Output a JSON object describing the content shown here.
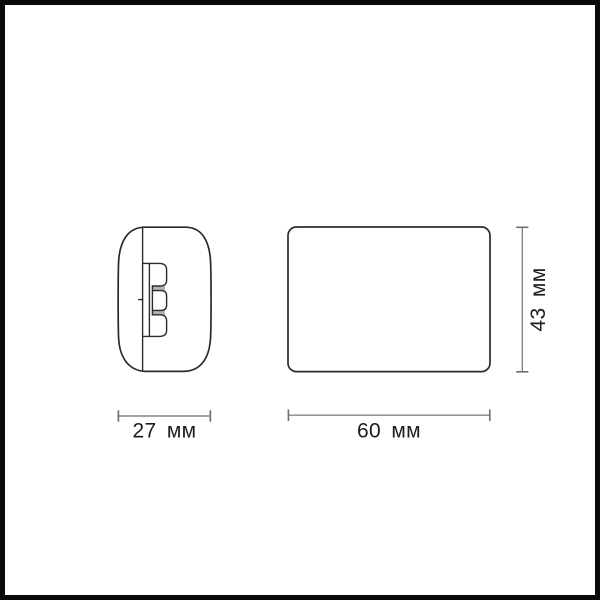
{
  "colors": {
    "frame": "#0a0a0a",
    "background": "#ffffff",
    "outline": "#2b2b2b",
    "dimension": "#868686",
    "dimension-tick": "#6d6d6d",
    "text": "#1d1d1d",
    "slot-shade": "#b2b2b2"
  },
  "drawing": {
    "side_view": {
      "width_label": "27 мм"
    },
    "front_view": {
      "width_label": "60 мм",
      "height_label": "43 мм"
    }
  }
}
